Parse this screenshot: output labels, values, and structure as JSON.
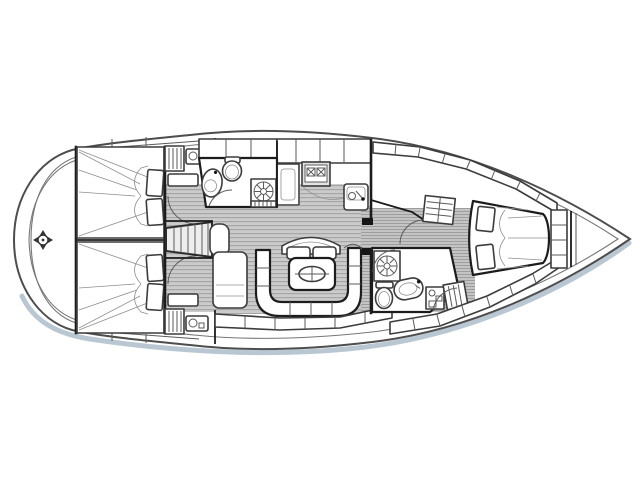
{
  "diagram": {
    "type": "sailboat-interior-floor-plan-line-drawing",
    "orientation": "bow-right-stern-left",
    "regions": [
      "stern-swim-platform",
      "aft-cabin-port-double-berth",
      "aft-cabin-starboard-double-berth",
      "companionway-stairs",
      "aft-head-with-shower",
      "galley",
      "salon-table-and-u-settee",
      "forward-head-with-shower",
      "forward-cabin-v-berth",
      "anchor-locker-bow"
    ],
    "symbols": [
      "steering-compass-marker-icon",
      "shower-drain-grate-icon",
      "stove-burner-x-icon",
      "sink-basin-icon",
      "toilet-icon",
      "table-centre-handle-icon",
      "companionway-steps-icon",
      "louvered-locker-icon",
      "berth-pillow-icon",
      "blanket-fan-icon"
    ]
  },
  "canvas": {
    "width": 640,
    "height": 480
  },
  "colors": {
    "background": "#ffffff",
    "outline": "#4a4a4a",
    "walls": "#1c1c1c",
    "floor_base": "#cbcbcb",
    "floor_stripe": "#a6a6a6",
    "hull_shadow": "#b4c4d0",
    "furniture_fill": "#ffffff",
    "accent_fill": "#ebebeb"
  }
}
